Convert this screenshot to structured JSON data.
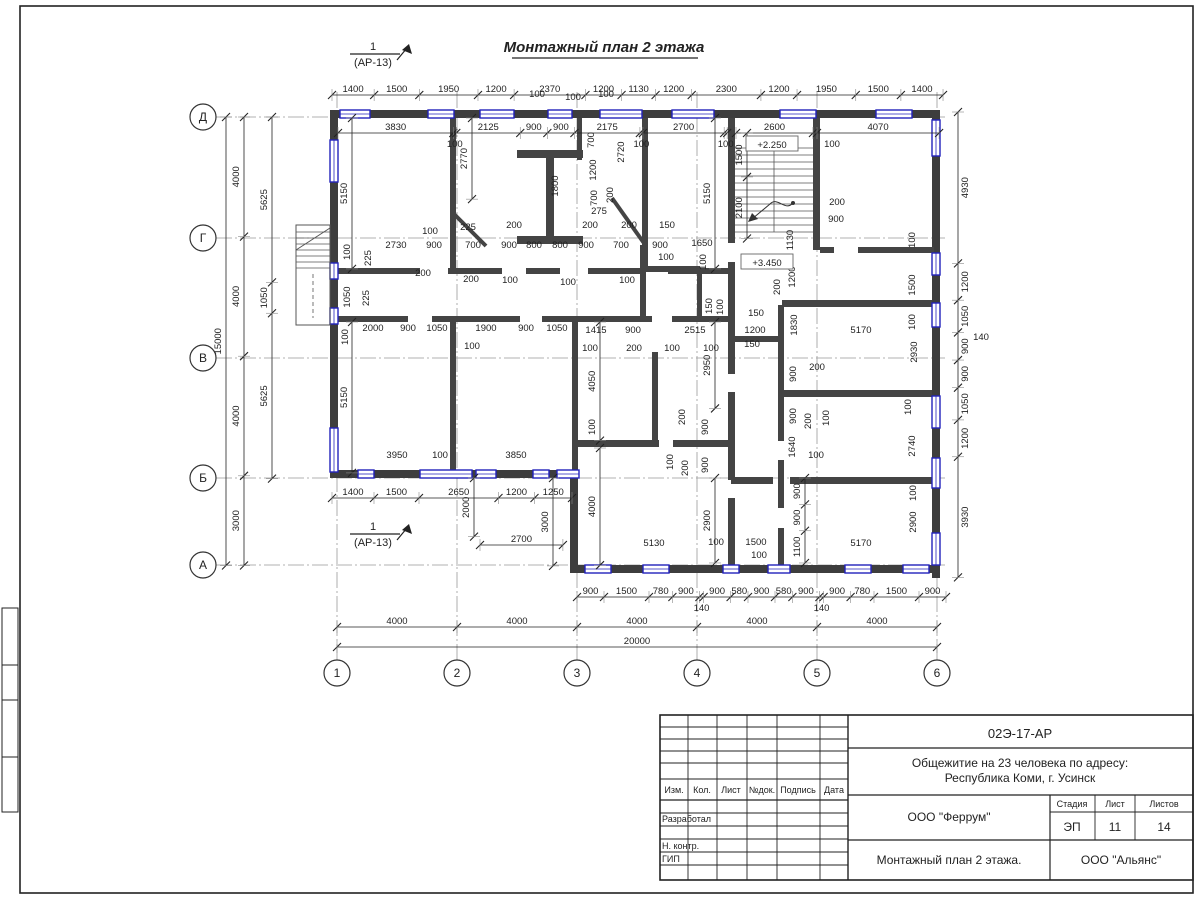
{
  "title": "Монтажный план 2 этажа",
  "section_marker": {
    "num": "1",
    "ref": "(АР-13)"
  },
  "axes": {
    "letters": [
      {
        "l": "Д",
        "y": 117
      },
      {
        "l": "Г",
        "y": 238
      },
      {
        "l": "В",
        "y": 358
      },
      {
        "l": "Б",
        "y": 478
      },
      {
        "l": "А",
        "y": 565
      }
    ],
    "numbers": [
      {
        "l": "1",
        "x": 337
      },
      {
        "l": "2",
        "x": 457
      },
      {
        "l": "3",
        "x": 577
      },
      {
        "l": "4",
        "x": 697
      },
      {
        "l": "5",
        "x": 817
      },
      {
        "l": "6",
        "x": 937
      }
    ]
  },
  "elevations": [
    {
      "x": 772,
      "y": 146,
      "t": "+2.250"
    },
    {
      "x": 767,
      "y": 264,
      "t": "+3.450"
    }
  ],
  "dim_chains": [
    {
      "d": "h",
      "x": 332,
      "y": 95,
      "s": 0.0301,
      "v": [
        1400,
        1500,
        1950,
        1200,
        2370,
        1200,
        1130,
        1200,
        2300,
        1200,
        1950,
        1500,
        1400
      ]
    },
    {
      "d": "h",
      "x": 338,
      "y": 133,
      "s": 0.0301,
      "v": [
        3830,
        100,
        2125,
        900,
        900,
        2175,
        100,
        2700,
        100
      ]
    },
    {
      "d": "h",
      "x": 736,
      "y": 133,
      "s": 0.0296,
      "v": [
        2600
      ]
    },
    {
      "d": "h",
      "x": 817,
      "y": 133,
      "s": 0.03,
      "v": [
        4070
      ]
    },
    {
      "d": "v",
      "x": 226,
      "y": 117,
      "s": 0.0299,
      "v": [
        15000
      ]
    },
    {
      "d": "v",
      "x": 244,
      "y": 117,
      "s": 0.0299,
      "v": [
        4000,
        4000,
        4000,
        3000
      ]
    },
    {
      "d": "v",
      "x": 272,
      "y": 117,
      "s": 0.0294,
      "v": [
        5625,
        1050,
        5625
      ]
    },
    {
      "d": "v",
      "x": 958,
      "y": 112,
      "s": 0.0307,
      "v": [
        4930,
        1200,
        1050,
        900,
        900,
        1050,
        1200,
        3930
      ],
      "ts": "r"
    },
    {
      "d": "h",
      "x": 577,
      "y": 597,
      "s": 0.03,
      "v": [
        900,
        1500,
        780,
        900,
        140,
        900,
        580,
        900,
        580,
        900,
        140,
        900,
        780,
        1500,
        900
      ]
    },
    {
      "d": "h",
      "x": 337,
      "y": 627,
      "s": 0.03,
      "v": [
        4000,
        4000,
        4000,
        4000,
        4000
      ]
    },
    {
      "d": "h",
      "x": 337,
      "y": 647,
      "s": 0.03,
      "v": [
        20000
      ]
    },
    {
      "d": "h",
      "x": 332,
      "y": 498,
      "s": 0.03,
      "v": [
        1400,
        1500,
        2650,
        1200,
        1250
      ]
    },
    {
      "d": "h",
      "x": 480,
      "y": 545,
      "s": 0.0307,
      "v": [
        2700
      ]
    },
    {
      "d": "v",
      "x": 747,
      "y": 133,
      "s": 0.0293,
      "v": [
        1500,
        2100
      ]
    },
    {
      "d": "v",
      "x": 352,
      "y": 118,
      "s": 0.0293,
      "v": [
        5150
      ]
    },
    {
      "d": "v",
      "x": 352,
      "y": 322,
      "s": 0.0293,
      "v": [
        5150
      ]
    },
    {
      "d": "v",
      "x": 715,
      "y": 118,
      "s": 0.0293,
      "v": [
        5150
      ]
    },
    {
      "d": "v",
      "x": 472,
      "y": 118,
      "s": 0.0293,
      "v": [
        2770
      ]
    },
    {
      "d": "v",
      "x": 600,
      "y": 322,
      "s": 0.0293,
      "v": [
        4050
      ]
    },
    {
      "d": "v",
      "x": 600,
      "y": 448,
      "s": 0.0293,
      "v": [
        4000
      ]
    },
    {
      "d": "v",
      "x": 553,
      "y": 478,
      "s": 0.0293,
      "v": [
        3000
      ]
    },
    {
      "d": "v",
      "x": 474,
      "y": 478,
      "s": 0.0293,
      "v": [
        2000
      ]
    },
    {
      "d": "v",
      "x": 715,
      "y": 322,
      "s": 0.0293,
      "v": [
        2950
      ]
    },
    {
      "d": "v",
      "x": 715,
      "y": 478,
      "s": 0.0293,
      "v": [
        2900
      ]
    },
    {
      "d": "v",
      "x": 805,
      "y": 478,
      "s": 0.0293,
      "v": [
        900,
        900,
        1100
      ]
    }
  ],
  "dim_texts": [
    {
      "x": 396,
      "y": 248,
      "t": "2730"
    },
    {
      "x": 430,
      "y": 234,
      "t": "100"
    },
    {
      "x": 434,
      "y": 248,
      "t": "900"
    },
    {
      "x": 468,
      "y": 230,
      "t": "225"
    },
    {
      "x": 473,
      "y": 248,
      "t": "700"
    },
    {
      "x": 514,
      "y": 228,
      "t": "200"
    },
    {
      "x": 509,
      "y": 248,
      "t": "900"
    },
    {
      "x": 534,
      "y": 248,
      "t": "800"
    },
    {
      "x": 560,
      "y": 248,
      "t": "800"
    },
    {
      "x": 586,
      "y": 248,
      "t": "900"
    },
    {
      "x": 599,
      "y": 214,
      "t": "275"
    },
    {
      "x": 590,
      "y": 228,
      "t": "200"
    },
    {
      "x": 629,
      "y": 228,
      "t": "200"
    },
    {
      "x": 621,
      "y": 248,
      "t": "700"
    },
    {
      "x": 667,
      "y": 228,
      "t": "150"
    },
    {
      "x": 660,
      "y": 248,
      "t": "900"
    },
    {
      "x": 666,
      "y": 260,
      "t": "100"
    },
    {
      "x": 702,
      "y": 246,
      "t": "1650"
    },
    {
      "x": 706,
      "y": 262,
      "t": "100",
      "r": 1
    },
    {
      "x": 350,
      "y": 252,
      "t": "100",
      "r": 1
    },
    {
      "x": 371,
      "y": 258,
      "t": "225",
      "r": 1
    },
    {
      "x": 350,
      "y": 297,
      "t": "1050",
      "r": 1
    },
    {
      "x": 369,
      "y": 298,
      "t": "225",
      "r": 1
    },
    {
      "x": 423,
      "y": 276,
      "t": "200"
    },
    {
      "x": 471,
      "y": 282,
      "t": "200"
    },
    {
      "x": 510,
      "y": 283,
      "t": "100"
    },
    {
      "x": 568,
      "y": 285,
      "t": "100"
    },
    {
      "x": 627,
      "y": 283,
      "t": "100"
    },
    {
      "x": 537,
      "y": 97,
      "t": "100"
    },
    {
      "x": 573,
      "y": 100,
      "t": "100"
    },
    {
      "x": 606,
      "y": 97,
      "t": "100"
    },
    {
      "x": 558,
      "y": 186,
      "t": "1800",
      "r": 1
    },
    {
      "x": 594,
      "y": 140,
      "t": "700",
      "r": 1
    },
    {
      "x": 596,
      "y": 170,
      "t": "1200",
      "r": 1
    },
    {
      "x": 597,
      "y": 198,
      "t": "700",
      "r": 1
    },
    {
      "x": 613,
      "y": 195,
      "t": "200",
      "r": 1
    },
    {
      "x": 624,
      "y": 152,
      "t": "2720",
      "r": 1
    },
    {
      "x": 832,
      "y": 147,
      "t": "100"
    },
    {
      "x": 837,
      "y": 205,
      "t": "200"
    },
    {
      "x": 836,
      "y": 222,
      "t": "900"
    },
    {
      "x": 793,
      "y": 240,
      "t": "1130",
      "r": 1
    },
    {
      "x": 795,
      "y": 277,
      "t": "1200",
      "r": 1
    },
    {
      "x": 780,
      "y": 287,
      "t": "200",
      "r": 1
    },
    {
      "x": 797,
      "y": 325,
      "t": "1830",
      "r": 1
    },
    {
      "x": 915,
      "y": 240,
      "t": "100",
      "r": 1
    },
    {
      "x": 915,
      "y": 285,
      "t": "1500",
      "r": 1
    },
    {
      "x": 915,
      "y": 322,
      "t": "100",
      "r": 1
    },
    {
      "x": 917,
      "y": 352,
      "t": "2930",
      "r": 1
    },
    {
      "x": 756,
      "y": 316,
      "t": "150"
    },
    {
      "x": 755,
      "y": 333,
      "t": "1200"
    },
    {
      "x": 752,
      "y": 347,
      "t": "150"
    },
    {
      "x": 695,
      "y": 333,
      "t": "2515"
    },
    {
      "x": 861,
      "y": 333,
      "t": "5170"
    },
    {
      "x": 712,
      "y": 306,
      "t": "150",
      "r": 1
    },
    {
      "x": 723,
      "y": 307,
      "t": "100",
      "r": 1
    },
    {
      "x": 348,
      "y": 337,
      "t": "100",
      "r": 1
    },
    {
      "x": 373,
      "y": 331,
      "t": "2000"
    },
    {
      "x": 408,
      "y": 331,
      "t": "900"
    },
    {
      "x": 437,
      "y": 331,
      "t": "1050"
    },
    {
      "x": 486,
      "y": 331,
      "t": "1900"
    },
    {
      "x": 526,
      "y": 331,
      "t": "900"
    },
    {
      "x": 557,
      "y": 331,
      "t": "1050"
    },
    {
      "x": 596,
      "y": 333,
      "t": "1415"
    },
    {
      "x": 633,
      "y": 333,
      "t": "900"
    },
    {
      "x": 472,
      "y": 349,
      "t": "100"
    },
    {
      "x": 590,
      "y": 351,
      "t": "100"
    },
    {
      "x": 634,
      "y": 351,
      "t": "200"
    },
    {
      "x": 672,
      "y": 351,
      "t": "100"
    },
    {
      "x": 711,
      "y": 351,
      "t": "100"
    },
    {
      "x": 595,
      "y": 427,
      "t": "100",
      "r": 1
    },
    {
      "x": 685,
      "y": 417,
      "t": "200",
      "r": 1
    },
    {
      "x": 673,
      "y": 462,
      "t": "100",
      "r": 1
    },
    {
      "x": 688,
      "y": 468,
      "t": "200",
      "r": 1
    },
    {
      "x": 708,
      "y": 427,
      "t": "900",
      "r": 1
    },
    {
      "x": 708,
      "y": 465,
      "t": "900",
      "r": 1
    },
    {
      "x": 654,
      "y": 546,
      "t": "5130"
    },
    {
      "x": 716,
      "y": 545,
      "t": "100"
    },
    {
      "x": 756,
      "y": 545,
      "t": "1500"
    },
    {
      "x": 759,
      "y": 558,
      "t": "100"
    },
    {
      "x": 861,
      "y": 546,
      "t": "5170"
    },
    {
      "x": 796,
      "y": 374,
      "t": "900",
      "r": 1
    },
    {
      "x": 817,
      "y": 370,
      "t": "200"
    },
    {
      "x": 796,
      "y": 416,
      "t": "900",
      "r": 1
    },
    {
      "x": 811,
      "y": 421,
      "t": "200",
      "r": 1
    },
    {
      "x": 829,
      "y": 418,
      "t": "100",
      "r": 1
    },
    {
      "x": 795,
      "y": 447,
      "t": "1640",
      "r": 1
    },
    {
      "x": 816,
      "y": 458,
      "t": "100"
    },
    {
      "x": 911,
      "y": 407,
      "t": "100",
      "r": 1
    },
    {
      "x": 915,
      "y": 446,
      "t": "2740",
      "r": 1
    },
    {
      "x": 916,
      "y": 493,
      "t": "100",
      "r": 1
    },
    {
      "x": 916,
      "y": 522,
      "t": "2900",
      "r": 1
    },
    {
      "x": 397,
      "y": 458,
      "t": "3950"
    },
    {
      "x": 440,
      "y": 458,
      "t": "100"
    },
    {
      "x": 516,
      "y": 458,
      "t": "3850"
    },
    {
      "x": 981,
      "y": 340,
      "t": "140"
    }
  ],
  "title_block": {
    "code": "02Э-17-АР",
    "object_line1": "Общежитие на 23 человека по адресу:",
    "object_line2": "Республика Коми, г. Усинск",
    "company": "ООО \"Феррум\"",
    "subtitle": "Монтажный план 2 этажа.",
    "contractor": "ООО \"Альянс\"",
    "stage_label": "Стадия",
    "sheet_label": "Лист",
    "sheets_label": "Листов",
    "stage": "ЭП",
    "sheet": "11",
    "sheets": "14",
    "col_headers": [
      "Изм.",
      "Кол.",
      "Лист",
      "№док.",
      "Подпись",
      "Дата"
    ],
    "row_labels": [
      "Разработал",
      "Н. контр.",
      "ГИП"
    ]
  }
}
